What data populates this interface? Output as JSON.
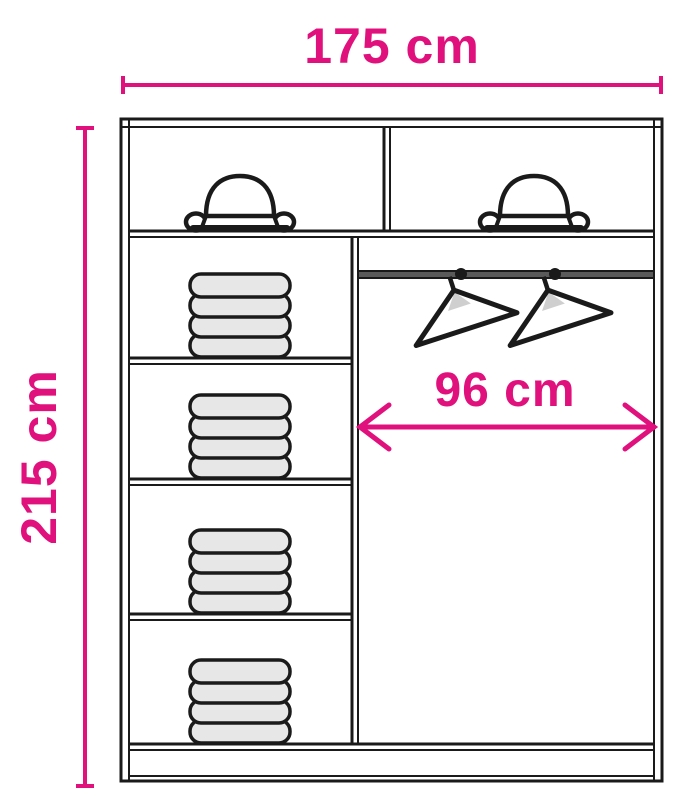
{
  "diagram": {
    "subject": "wardrobe-interior-dimension-diagram",
    "labels": {
      "total_width": "175 cm",
      "total_height": "215 cm",
      "hanging_width": "96 cm"
    },
    "colors": {
      "dimension": "#e0107c",
      "outline": "#1a1a1a",
      "cloth_fill": "#e7e7e7",
      "rail_fill": "#5a5a5a",
      "hanger_shade": "#cfcfcf",
      "background": "#ffffff"
    },
    "icons": {
      "hat": "hat-icon",
      "hanger": "hanger-icon",
      "folded_clothes": "folded-clothes-stack"
    },
    "counts": {
      "hat_compartments": 2,
      "shelf_compartments": 4,
      "folded_stacks": 4,
      "items_per_stack": 4,
      "hangers": 2
    }
  }
}
